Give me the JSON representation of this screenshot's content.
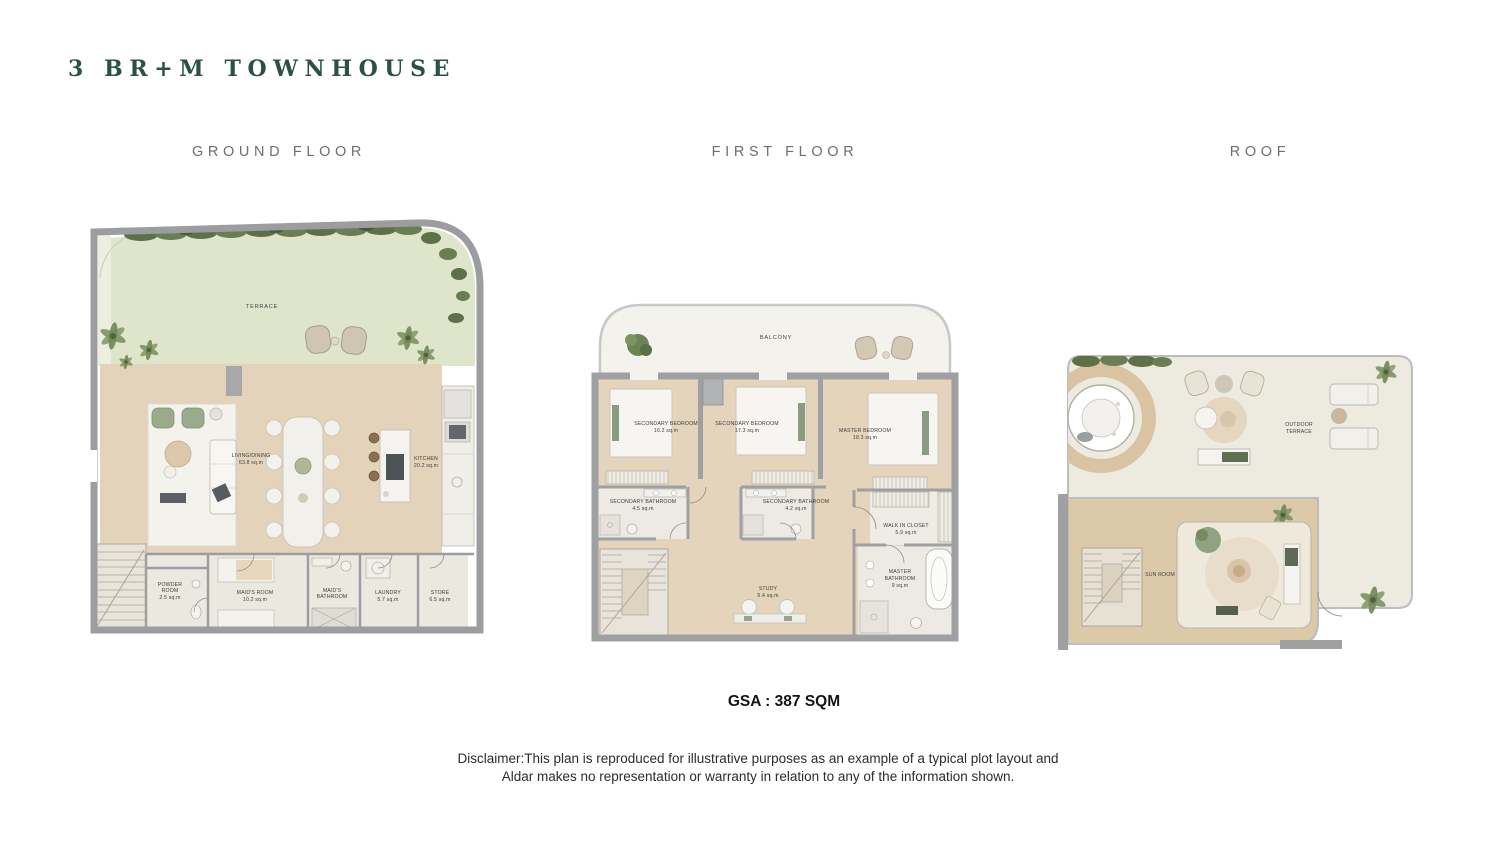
{
  "title": "3 BR+M TOWNHOUSE",
  "headers": {
    "ground": "GROUND FLOOR",
    "first": "FIRST FLOOR",
    "roof": "ROOF"
  },
  "gsa": "GSA : 387 SQM",
  "disclaimer": {
    "line1": "Disclaimer:This plan is reproduced for illustrative purposes as an example of a typical plot layout and",
    "line2": "Aldar makes no representation or warranty in relation to any of the information shown."
  },
  "ground": {
    "terrace": "TERRACE",
    "living": {
      "name": "LIVING/DINING",
      "area": "63.8 sq.m"
    },
    "kitchen": {
      "name": "KITCHEN",
      "area": "20.2 sq.m"
    },
    "powder": {
      "l1": "POWDER",
      "l2": "ROOM",
      "area": "2.5 sq.m"
    },
    "maids_room": {
      "name": "MAID'S ROOM",
      "area": "10.2 sq.m"
    },
    "maids_bath": {
      "l1": "MAID'S",
      "l2": "BATHROOM"
    },
    "laundry": {
      "name": "LAUNDRY",
      "area": "5.7 sq.m"
    },
    "store": {
      "name": "STORE",
      "area": "6.5 sq.m"
    }
  },
  "first": {
    "balcony": "BALCONY",
    "bedroom1": {
      "name": "SECONDARY BEDROOM",
      "area": "16.2 sq.m"
    },
    "bedroom2": {
      "name": "SECONDARY BEDROOM",
      "area": "17.3 sq.m"
    },
    "master_bedroom": {
      "name": "MASTER BEDROOM",
      "area": "18.3 sq.m"
    },
    "bath1": {
      "name": "SECONDARY BATHROOM",
      "area": "4.5 sq.m"
    },
    "bath2": {
      "name": "SECONDARY BATHROOM",
      "area": "4.2 sq.m"
    },
    "wic": {
      "name": "WALK IN CLOSET",
      "area": "5.9 sq.m"
    },
    "master_bath": {
      "l1": "MASTER",
      "l2": "BATHROOM",
      "area": "9 sq.m"
    },
    "study": {
      "name": "STUDY",
      "area": "5.4 sq.m"
    }
  },
  "roof": {
    "outdoor_terrace": {
      "l1": "OUTDOOR",
      "l2": "TERRACE"
    },
    "sun_room": "SUN ROOM"
  },
  "colors": {
    "title_green": "#2a5144",
    "heading_gray": "#6f6f6f",
    "wall_gray": "#9fa0a2",
    "wood_floor": "#e3d3ba",
    "lawn_green": "#dfe5ca",
    "shrub_green": "#5d7048"
  }
}
